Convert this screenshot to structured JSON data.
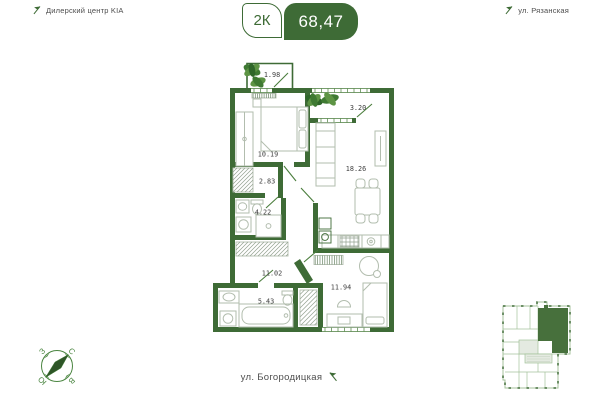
{
  "header": {
    "left_landmark": "Дилерский центр KIA",
    "right_landmark": "ул. Рязанская",
    "rooms_badge": "2К",
    "total_area": "68,47"
  },
  "footer": {
    "street": "ул. Богородицкая"
  },
  "compass": {
    "north": "С",
    "south": "Ю",
    "east": "В",
    "west": "З"
  },
  "plan": {
    "areas": [
      {
        "room": "balcony-top",
        "value": "1.98"
      },
      {
        "room": "balcony-right",
        "value": "3.20"
      },
      {
        "room": "bedroom",
        "value": "10.19"
      },
      {
        "room": "living-room",
        "value": "18.26"
      },
      {
        "room": "closet",
        "value": "2.83"
      },
      {
        "room": "bathroom-small",
        "value": "4.22"
      },
      {
        "room": "hallway",
        "value": "11.02"
      },
      {
        "room": "bathroom",
        "value": "5.43"
      },
      {
        "room": "room",
        "value": "11.94"
      }
    ]
  },
  "colors": {
    "wall": "#3E6B36",
    "door": "#4a7d3c",
    "furniture": "#b2bdae",
    "hatch": "#93a290",
    "label": "#3f3f3f",
    "compass": "#4a8540",
    "miniplan_outline": "#a4c29b",
    "miniplan_unit": "#47703C",
    "miniplan_corridor": "#e4eae1"
  }
}
